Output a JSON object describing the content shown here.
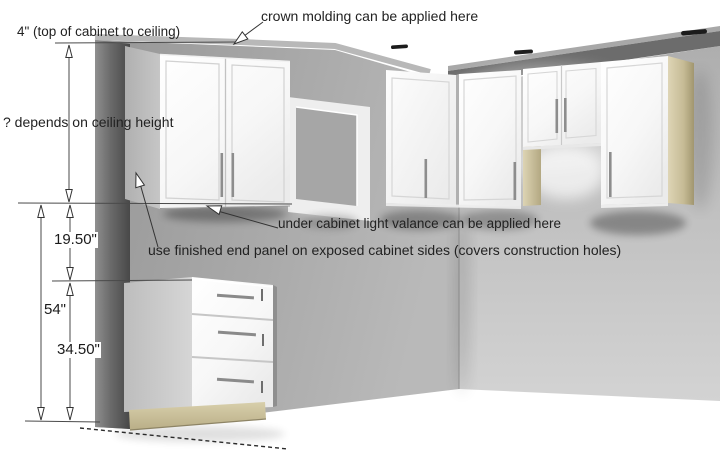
{
  "annotations": {
    "top_gap": "4\" (top of cabinet to ceiling)",
    "crown_molding": "crown molding can be applied here",
    "ceiling_height": "? depends on ceiling height",
    "valance": "under cabinet light valance can be applied here",
    "end_panel": "use finished end panel on exposed cabinet sides (covers construction holes)"
  },
  "dimensions": {
    "upper_gap": "19.50\"",
    "floor_to_wall_cabinet": "54\"",
    "base_height": "34.50\""
  },
  "icons": {
    "dimension_arrow": "open-triangle-arrow",
    "leader_arrow": "open-triangle-arrow",
    "recessed_light": "dark-dash-mark"
  },
  "colors": {
    "text": "#222222",
    "left_wall": "#a6a6a6",
    "back_wall": "#c2c2c2",
    "ceiling_band": "#6c6c6c",
    "wall_section_strip": "#5a5a5a",
    "cabinet_white": "#fbfbfb",
    "exposed_side_gray": "#bdbdbd",
    "unfinished_wood": "#cec4a0",
    "dimension_line": "#4a4a4a"
  }
}
